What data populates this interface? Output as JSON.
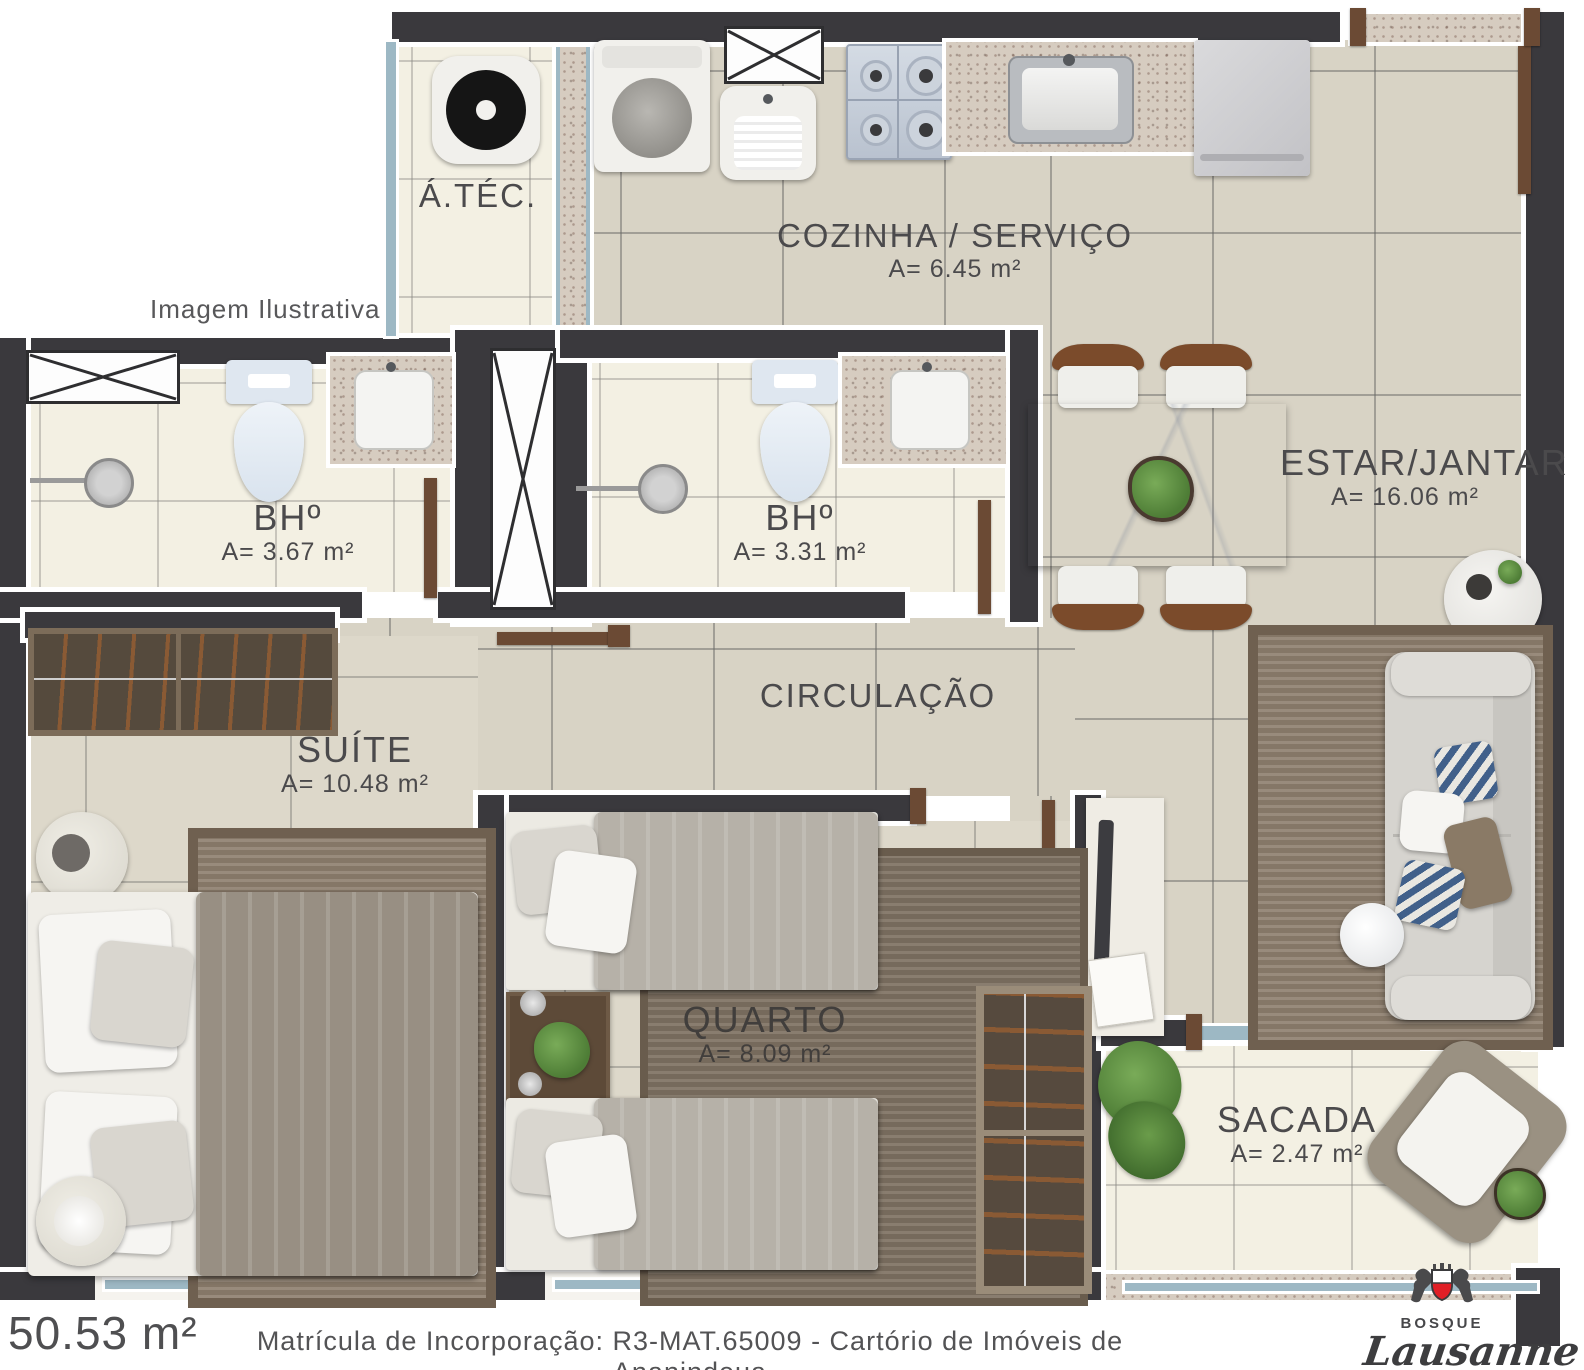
{
  "watermark": "Imagem Ilustrativa",
  "rooms": {
    "atec": {
      "name": "Á.TÉC.",
      "area": ""
    },
    "cozinha": {
      "name": "COZINHA / SERVIÇO",
      "area": "A= 6.45 m²"
    },
    "estar": {
      "name": "ESTAR/JANTAR",
      "area": "A= 16.06 m²"
    },
    "bh1": {
      "name": "BHº",
      "area": "A= 3.67 m²"
    },
    "bh2": {
      "name": "BHº",
      "area": "A= 3.31 m²"
    },
    "circulacao": {
      "name": "CIRCULAÇÃO",
      "area": ""
    },
    "suite": {
      "name": "SUÍTE",
      "area": "A= 10.48 m²"
    },
    "quarto": {
      "name": "QUARTO",
      "area": "A= 8.09 m²"
    },
    "sacada": {
      "name": "SACADA",
      "area": "A= 2.47 m²"
    }
  },
  "footer": {
    "total_area": "50.53 m²",
    "registration": "Matrícula de Incorporação: R3-MAT.65009 - Cartório de Imóveis de Ananindeua"
  },
  "logo": {
    "name_top": "BOSQUE",
    "name_script": "Lausanne"
  },
  "colors": {
    "wall": "#3a393d",
    "floor": "#d8d3c5",
    "floor_light": "#f3f0e3",
    "granite": "#d6ccc0",
    "glass": "#9db8c4",
    "door": "#6b4a34",
    "logo_red": "#e01f26",
    "label_text": "#4b4a4c"
  }
}
